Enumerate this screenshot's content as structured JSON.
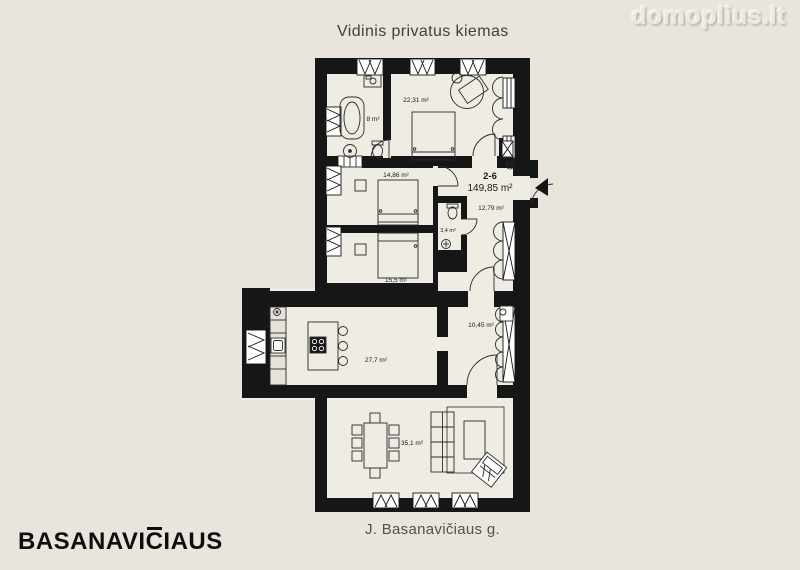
{
  "header": {
    "courtyard_label": "Vidinis privatus kiemas",
    "watermark": "domoplius.lt"
  },
  "plan": {
    "apartment": {
      "number": "2-6",
      "total_area": "149,85 m²"
    },
    "rooms": {
      "bedroom_top": "22,31 m²",
      "bathroom": "8 m²",
      "bedroom_mid": "14,86 m²",
      "hallway": "12,79 m²",
      "wc": "3,4 m²",
      "bedroom_low": "15,5 m²",
      "utility": "10,45 m²",
      "kitchen": "27,7 m²",
      "living": "35,1 m²"
    }
  },
  "footer": {
    "logo_prefix": "BASANAVI",
    "logo_c": "C",
    "logo_suffix": "IAUS",
    "street": "J. Basanavičiaus g."
  },
  "colors": {
    "background": "#e9e5dc",
    "floor": "#efece4",
    "wall": "#161616",
    "window": "#fdfdfb"
  }
}
